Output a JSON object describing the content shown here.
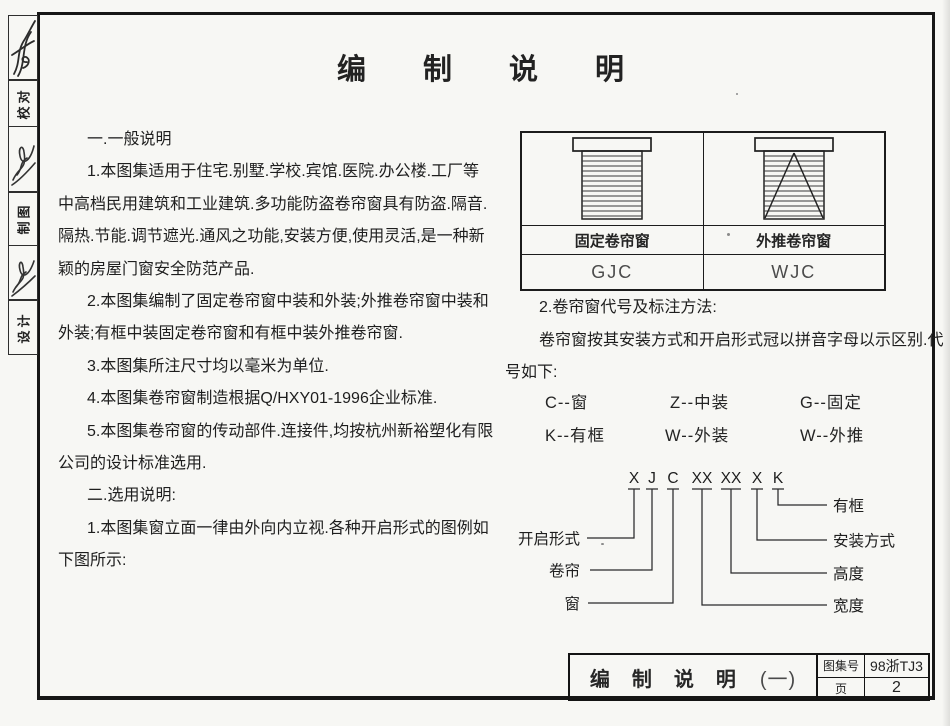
{
  "sheet": {
    "title": "编制说明",
    "margin_labels": [
      "校对",
      "制图",
      "设计"
    ]
  },
  "notes_left": {
    "lines": [
      "一.一般说明",
      "1.本图集适用于住宅.别墅.学校.宾馆.医院.办公楼.工厂等",
      "中高档民用建筑和工业建筑.多功能防盗卷帘窗具有防盗.隔音.",
      "隔热.节能.调节遮光.通风之功能,安装方便,使用灵活,是一种新",
      "颖的房屋门窗安全防范产品.",
      "2.本图集编制了固定卷帘窗中装和外装;外推卷帘窗中装和",
      "外装;有框中装固定卷帘窗和有框中装外推卷帘窗.",
      "3.本图集所注尺寸均以毫米为单位.",
      "4.本图集卷帘窗制造根据Q/HXY01-1996企业标准.",
      "5.本图集卷帘窗的传动部件.连接件,均按杭州新裕塑化有限",
      "公司的设计标准选用.",
      "二.选用说明:",
      "1.本图集窗立面一律由外向内立视.各种开启形式的图例如",
      "下图所示:"
    ]
  },
  "legend_table": {
    "columns": [
      {
        "label": "固定卷帘窗",
        "code": "GJC",
        "icon": "fixed-roller-shutter-window"
      },
      {
        "label": "外推卷帘窗",
        "code": "WJC",
        "icon": "push-out-roller-shutter-window"
      }
    ]
  },
  "notes_right": {
    "lines": [
      "2.卷帘窗代号及标注方法:",
      "卷帘窗按其安装方式和开启形式冠以拼音字母以示区别.代",
      "号如下:"
    ],
    "codes": [
      [
        "C--窗",
        "Z--中装",
        "G--固定"
      ],
      [
        "K--有框",
        "W--外装",
        "W--外推"
      ]
    ]
  },
  "code_diagram": {
    "tokens": [
      "X",
      "J",
      "C",
      "XX",
      "XX",
      "X",
      "K"
    ],
    "left_labels": [
      "开启形式",
      "卷帘",
      "窗"
    ],
    "right_labels": [
      "有框",
      "安装方式",
      "高度",
      "宽度"
    ]
  },
  "title_block": {
    "title": "编制说明",
    "title_suffix": "(一)",
    "atlas_label": "图集号",
    "atlas_no": "98浙TJ3",
    "page_label": "页",
    "page_no": "2"
  }
}
